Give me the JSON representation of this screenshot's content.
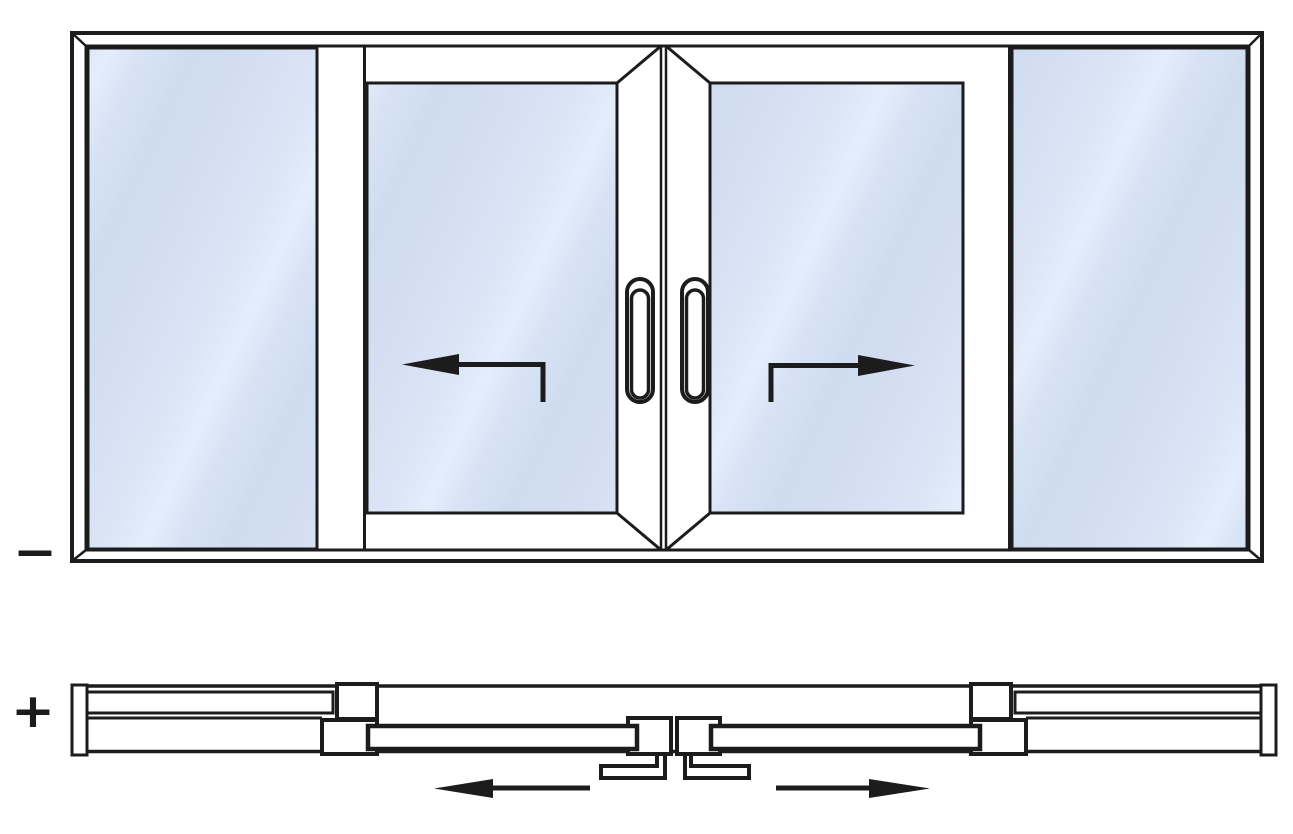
{
  "figure": {
    "kind": "technical-diagram",
    "subject": "4-panel sliding door / window scheme OKKP-type: elevation view and horizontal section",
    "views": [
      {
        "id": "elevation-view",
        "label": "−",
        "description": "Front elevation: outer frame, left fixed glazing, two central sliding sashes with handles opening outward (left sash slides left, right sash slides right), right fixed glazing",
        "panels": [
          {
            "name": "fixed-panel-left",
            "type": "fixed-glazing"
          },
          {
            "name": "sliding-sash-left",
            "type": "sliding",
            "direction": "left"
          },
          {
            "name": "sliding-sash-right",
            "type": "sliding",
            "direction": "right"
          },
          {
            "name": "fixed-panel-right",
            "type": "fixed-glazing"
          }
        ],
        "arrows": [
          {
            "name": "slide-arrow-left",
            "direction": "left"
          },
          {
            "name": "slide-arrow-right",
            "direction": "right"
          }
        ],
        "handles": 2
      },
      {
        "id": "plan-view",
        "label": "+",
        "description": "Horizontal section through the door: fixed panels on outer track with end caps, sliding panels on inner track, central interlock with floor guide brackets, slide-direction arrows",
        "arrows": [
          {
            "name": "slide-arrow-left",
            "direction": "left"
          },
          {
            "name": "slide-arrow-right",
            "direction": "right"
          }
        ]
      }
    ]
  },
  "labels": {
    "minus": "−",
    "plus": "+"
  },
  "theme": {
    "line_color": "#1c1c1c",
    "glass_color": "#d6e1f4",
    "glass_highlight": "#e4edfb",
    "background": "#ffffff"
  }
}
